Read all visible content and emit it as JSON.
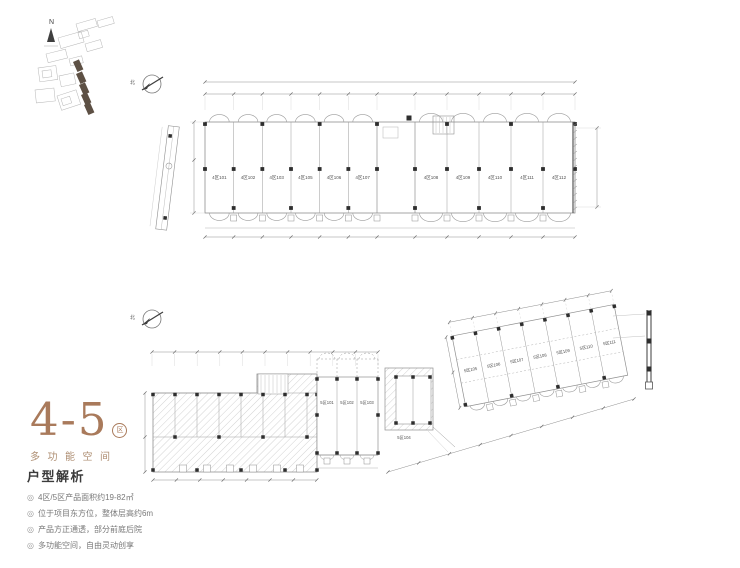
{
  "site_plan": {
    "north_label": "N"
  },
  "plans": {
    "top": {
      "compass_label": "北",
      "units": [
        "4区101",
        "4区102",
        "4区103",
        "4区105",
        "4区106",
        "4区107",
        "4区108",
        "4区109",
        "4区110",
        "4区111",
        "4区112"
      ]
    },
    "middle": {
      "compass_label": "北",
      "units_center": [
        "5区101",
        "5区102",
        "5区103"
      ],
      "unit_single": "5区104",
      "units_angled": [
        "5区105",
        "5区106",
        "5区107",
        "5区108",
        "5区109",
        "5区110",
        "5区111"
      ]
    }
  },
  "title_block": {
    "number": "4-5",
    "badge": "区",
    "subtitle": "多功能空间"
  },
  "analysis": {
    "heading": "户型解析",
    "bullet_icon": "◎",
    "bullets": [
      "4区/5区产品面积约19-82㎡",
      "位于项目东方位，整体层高约6m",
      "产品方正通透，部分前庭后院",
      "多功能空间，自由灵动创享"
    ]
  },
  "colors": {
    "accent_brown": "#a97a5b",
    "subtitle_brown": "#ae8e72",
    "site_highlight": "#5d5044",
    "line_gray": "#8f8f8f",
    "text_gray": "#787878"
  }
}
